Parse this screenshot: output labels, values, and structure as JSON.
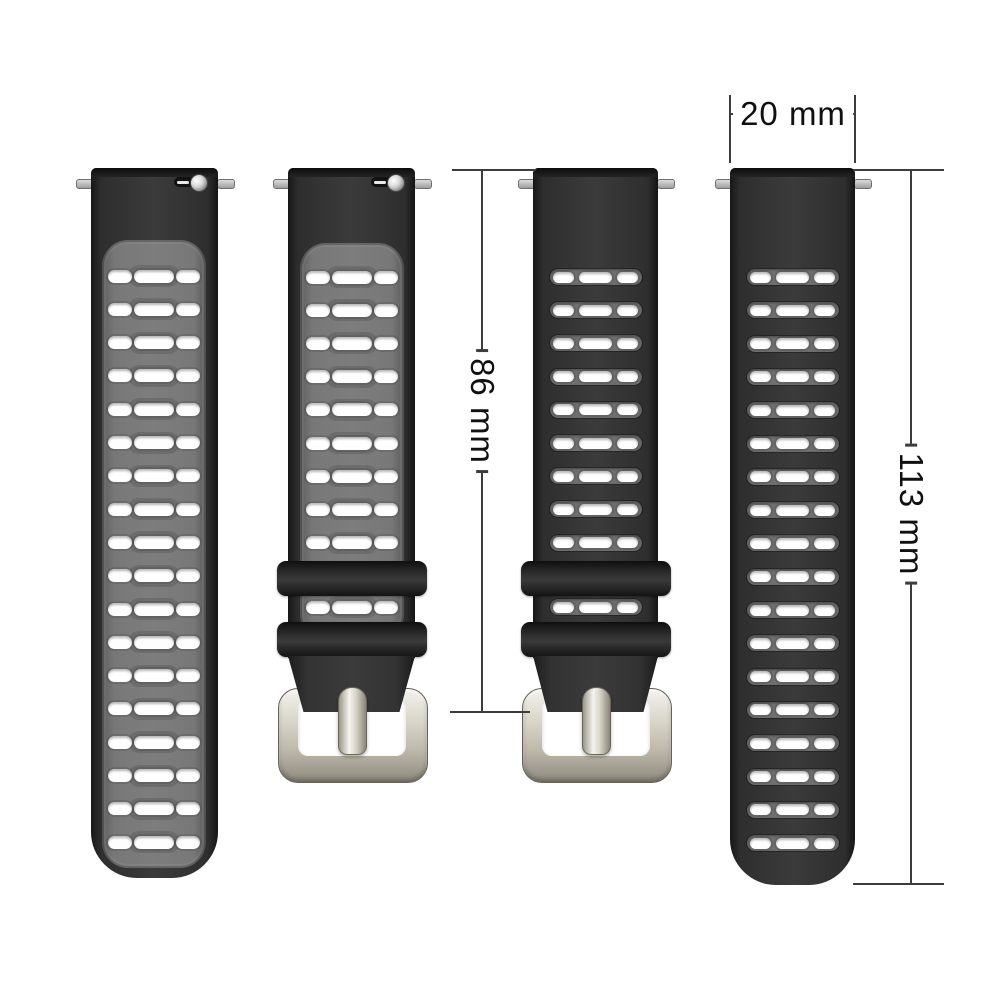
{
  "scene": {
    "description": "Silicone two-tone watch strap set shown in black-gray and black colorways with dimension callouts",
    "background": "#ffffff"
  },
  "dim_width": {
    "label": "20 mm"
  },
  "dim_buckle_strap": {
    "label": "86 mm"
  },
  "dim_long_strap": {
    "label": "113 mm"
  },
  "colors": {
    "strap_black": "#2e2e2e",
    "panel_gray": "#787878",
    "hole_white": "#fefefe",
    "buckle_silver": "#d9d5c9",
    "dimension_line": "#3c3c3c",
    "dimension_text": "#101010"
  },
  "bands": [
    {
      "name": "two-tone-long-strap",
      "colorway": "black-gray",
      "hole_style": "panel",
      "center_x": 154,
      "width": 127,
      "top": 168,
      "bottom": 878,
      "bottom_radius": 46,
      "rows": 18,
      "row_start_y": 276,
      "row_spacing": 33.3,
      "panel_top": 240,
      "panel_bottom": 868,
      "pins": true,
      "quick_release": true
    },
    {
      "name": "two-tone-buckle-strap",
      "colorway": "black-gray",
      "hole_style": "panel",
      "center_x": 351.5,
      "width": 127,
      "top": 168,
      "rows": 9,
      "row_start_y": 277,
      "row_spacing": 33.2,
      "panel_top": 243,
      "panel_bottom": 640,
      "keeper_row_y": 607,
      "keepers": [
        561,
        622
      ],
      "keeper_w": 150,
      "keeper_h": 35,
      "taper_top": 656,
      "taper_bottom": 712,
      "taper_bottom_width": 96,
      "buckle_top": 688,
      "buckle_bottom": 781,
      "buckle_w": 148,
      "pins": true,
      "quick_release": true
    },
    {
      "name": "black-buckle-strap",
      "colorway": "black",
      "hole_style": "slot",
      "center_x": 595.5,
      "width": 125,
      "top": 168,
      "rows": 9,
      "row_start_y": 277,
      "row_spacing": 33.2,
      "keeper_row_y": 607,
      "keepers": [
        561,
        622
      ],
      "keeper_w": 150,
      "keeper_h": 35,
      "taper_top": 656,
      "taper_bottom": 712,
      "taper_bottom_width": 96,
      "buckle_top": 688,
      "buckle_bottom": 781,
      "buckle_w": 148,
      "pins": true,
      "quick_release": false
    },
    {
      "name": "black-long-strap",
      "colorway": "black",
      "hole_style": "slot",
      "center_x": 792.5,
      "width": 125,
      "top": 168,
      "bottom": 885,
      "bottom_radius": 46,
      "rows": 18,
      "row_start_y": 277,
      "row_spacing": 33.3,
      "pins": true,
      "quick_release": false
    }
  ]
}
